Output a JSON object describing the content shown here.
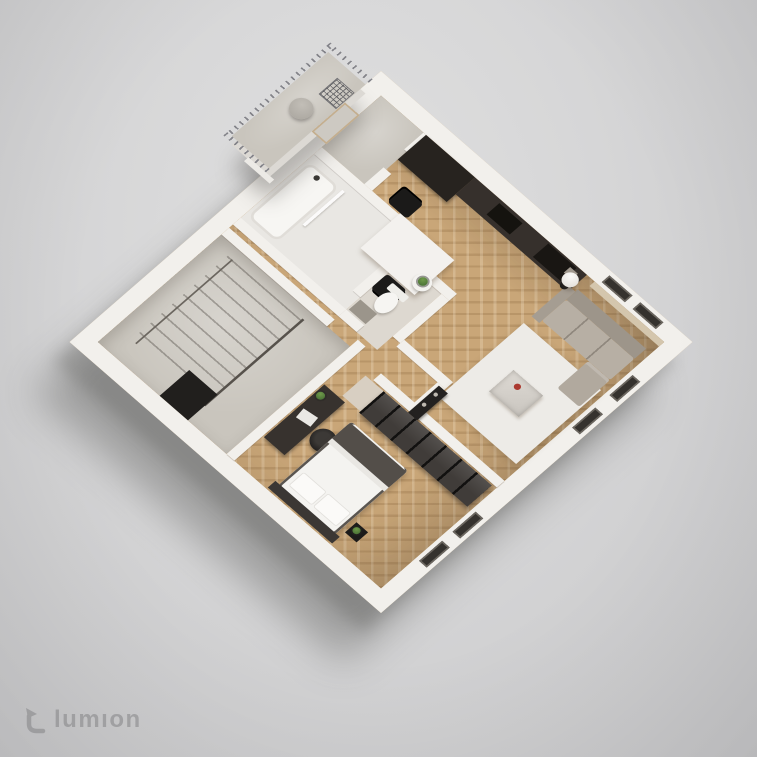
{
  "watermark": {
    "logo_icon": "lumion-logo-icon",
    "text": "lumıon"
  },
  "background": {
    "top": "#e0e0e0",
    "bottom": "#c6c6c8"
  },
  "floorplan": {
    "style": "isometric-3d-floor-plan-render",
    "wall_color": "#f2f0ec",
    "wood_floor_color": "#c9a678",
    "concrete_floor_color": "#c9c5bd",
    "kitchen_cabinet_color": "#27231f",
    "sofa_color": "#b7afa4",
    "accent_flower_color": "#ab3a30",
    "rooms": [
      "balcony",
      "entry-vestibule",
      "kitchen-dining",
      "living-room",
      "bathroom",
      "wc",
      "hallway",
      "stairwell",
      "bedroom"
    ],
    "furniture": [
      "balcony-railing",
      "outdoor-pouf",
      "wire-chair",
      "kitchen-tall-units",
      "kitchen-counter",
      "cooktop",
      "sink",
      "dining-table",
      "dining-chairs",
      "floor-lamp",
      "sofa",
      "chaise",
      "area-rug",
      "coffee-table",
      "flower-vase",
      "console-cabinet",
      "bathtub",
      "shower-panel",
      "toilet",
      "side-table",
      "bath-mat",
      "stairs",
      "stair-railing",
      "stair-void",
      "wardrobe",
      "desk",
      "laptop",
      "office-chair",
      "bed",
      "bed-blanket",
      "pillows",
      "headboard",
      "nightstand",
      "plants",
      "windows"
    ]
  }
}
